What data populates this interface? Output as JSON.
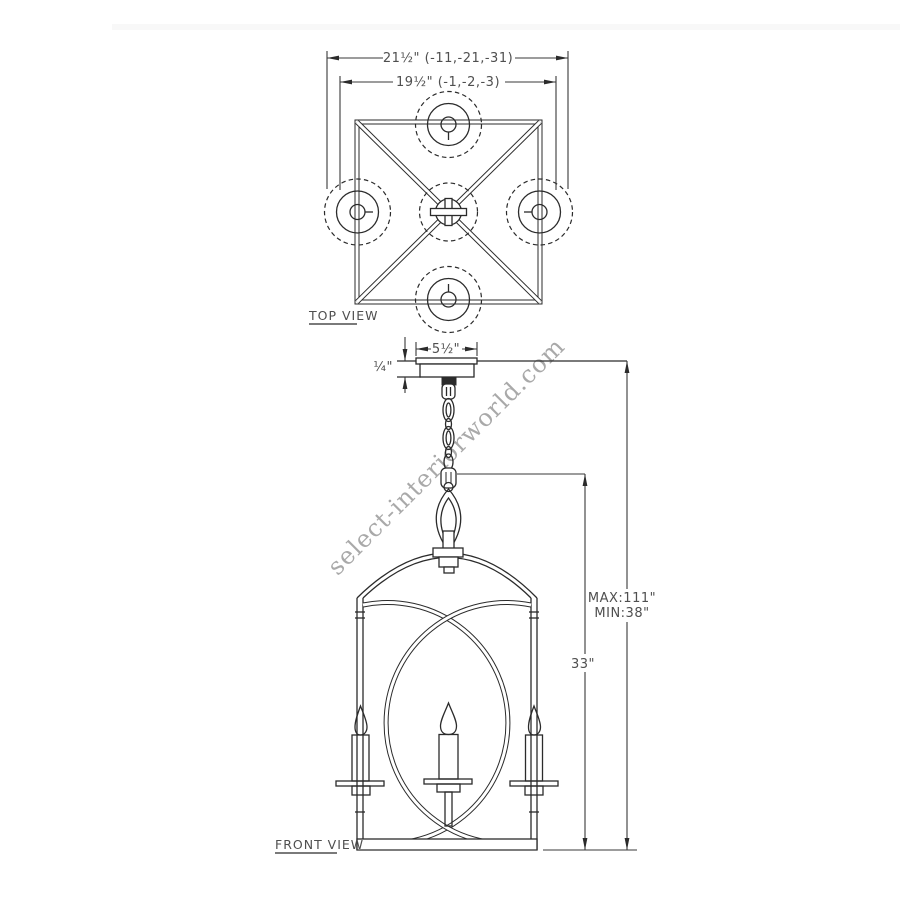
{
  "watermark": {
    "text": "select-interiorworld.com"
  },
  "top_view": {
    "label": "TOP VIEW",
    "dim_overall_width": "21½\" (-11,-21,-31)",
    "dim_inner_width": "19½\" (-1,-2,-3)"
  },
  "front_view": {
    "label": "FRONT VIEW",
    "dim_canopy_width": "5½\"",
    "dim_canopy_height": "¼\"",
    "dim_body_height": "33\"",
    "dim_max_height": "MAX:111\"",
    "dim_min_height": "MIN:38\""
  },
  "colors": {
    "line": "#2b2b2b",
    "dimension_text": "#4f4f4f",
    "watermark": "#9b9b9b",
    "background": "#ffffff"
  }
}
